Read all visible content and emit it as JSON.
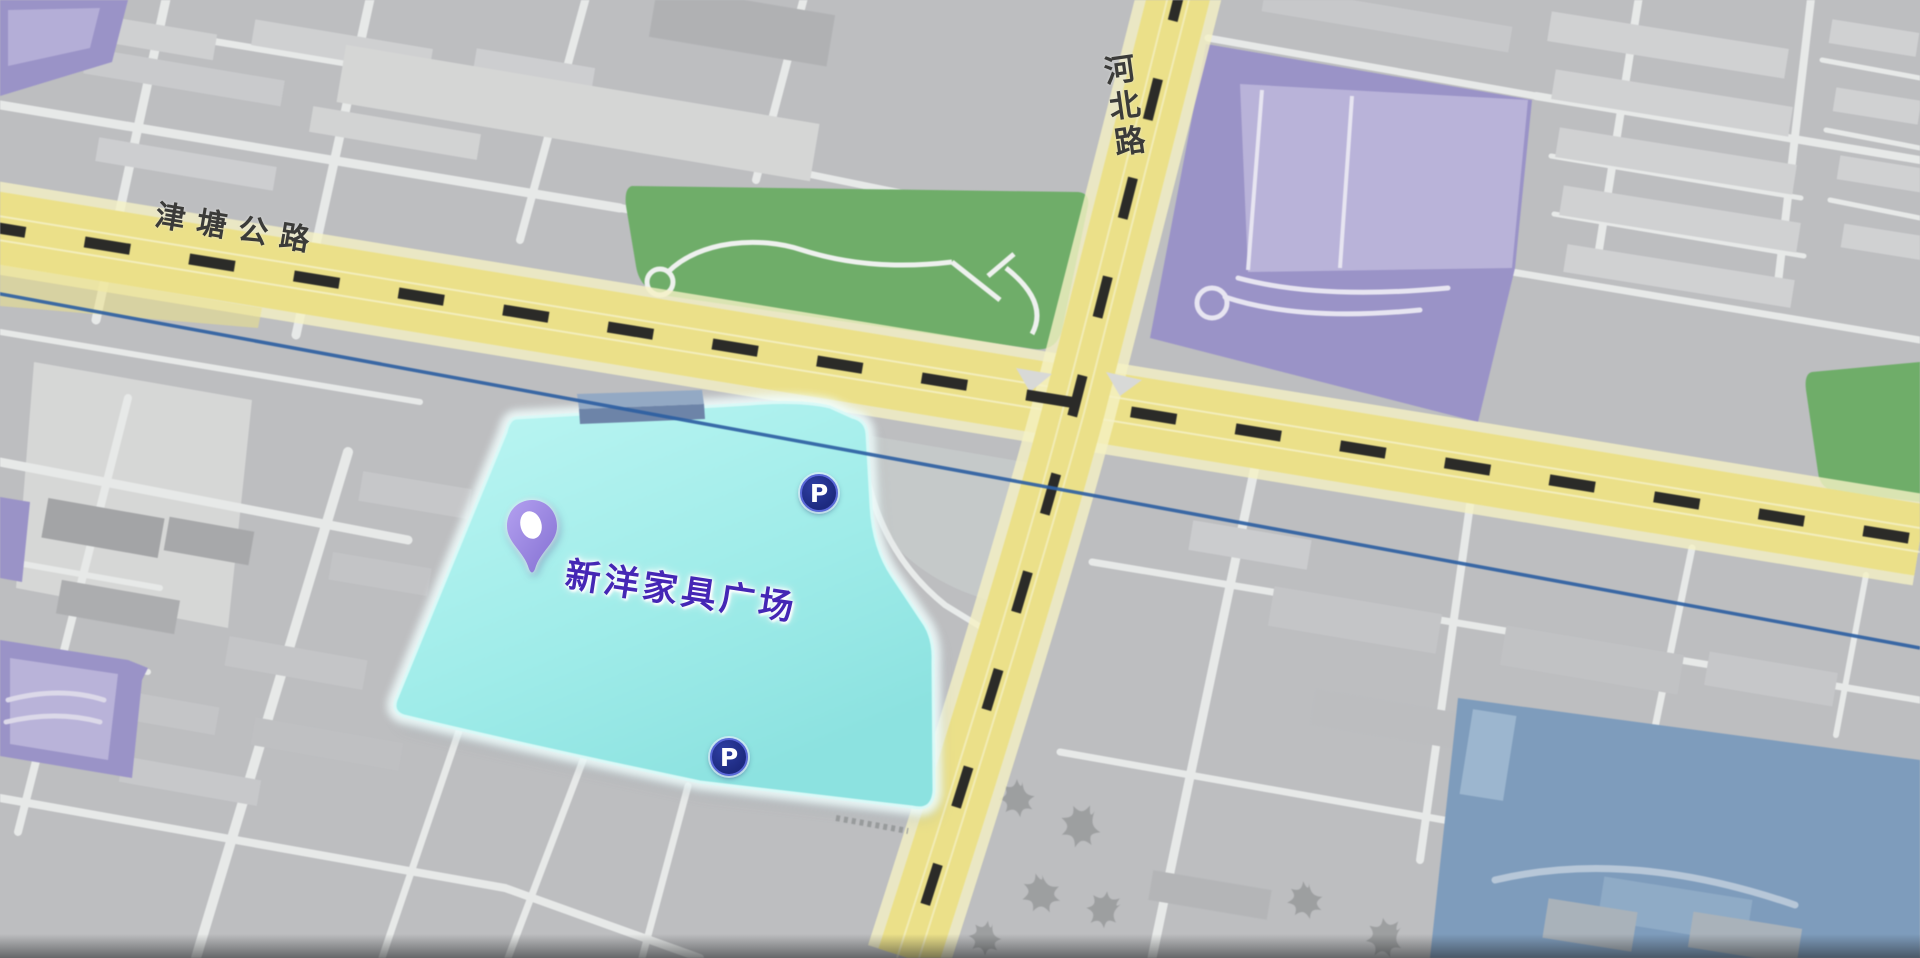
{
  "map_view": {
    "road_labels": [
      {
        "id": "jintang-highway",
        "text": "津塘公路",
        "orientation": "along-road-horizontal"
      },
      {
        "id": "hebei-road",
        "text": "河北路",
        "orientation": "vertical-column"
      }
    ],
    "poi": {
      "label": "新洋家具广场",
      "marker": "location-pin-icon",
      "highlight": "cyan-building-footprint"
    },
    "parking_markers": [
      {
        "symbol": "P",
        "position": "northeast-corner-of-building"
      },
      {
        "symbol": "P",
        "position": "south-edge-of-building"
      }
    ],
    "colors": {
      "base_gray": "#bdbec0",
      "road_minor": "#e7e9e8",
      "road_major_yellow": "#ebe089",
      "road_major_glow": "#f5f1c4",
      "road_dash_black": "#2b2b28",
      "park_green": "#6fad69",
      "building_purple": "#9a93c7",
      "building_purple_light": "#b9b3d9",
      "building_blue": "#7e9cbc",
      "highlight_cyan": "#aaf0ed",
      "highlight_cyan_deep": "#93e4e1",
      "boundary_blue_line": "#2e5fa2",
      "pin_purple": "#9d8ce0",
      "poi_text": "#4527b5",
      "road_text": "#3b3b39",
      "parking_navy": "#1d2a80"
    }
  }
}
